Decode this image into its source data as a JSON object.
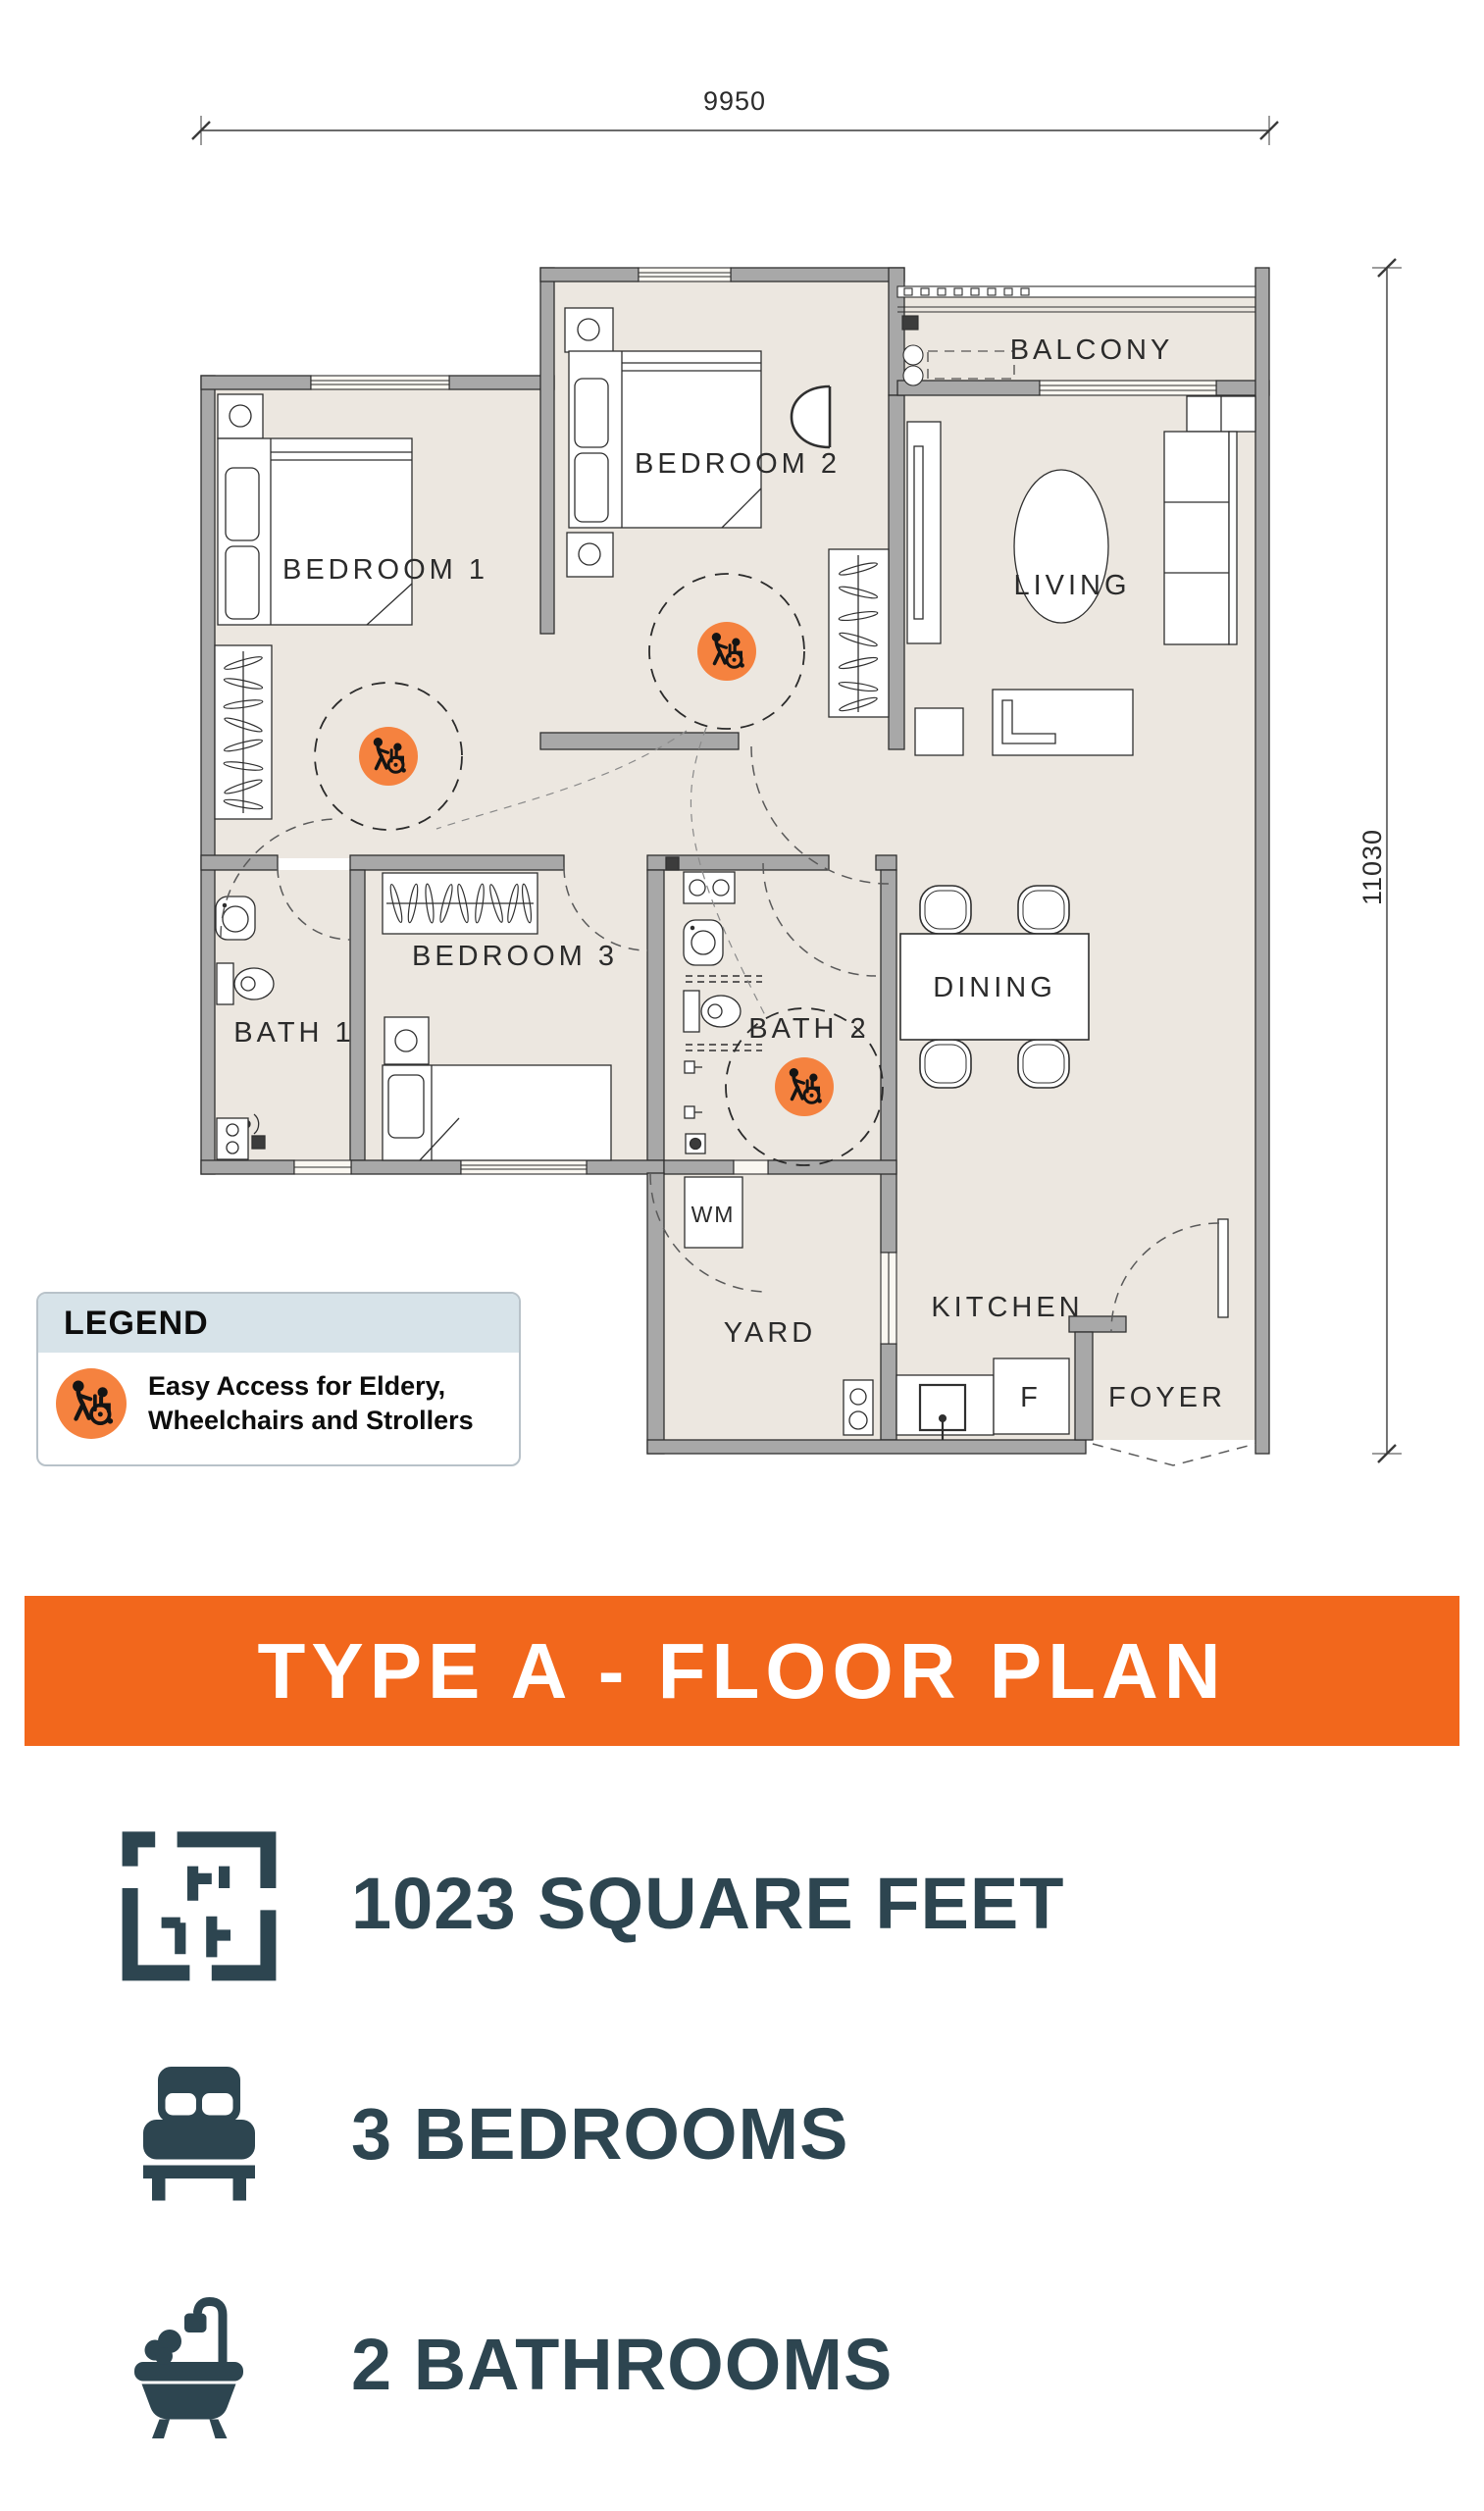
{
  "plan": {
    "dimensions": {
      "width": "9950",
      "height": "11030"
    },
    "labels": {
      "bedroom1": "BEDROOM 1",
      "bedroom2": "BEDROOM 2",
      "bedroom3": "BEDROOM 3",
      "bath1": "BATH 1",
      "bath2": "BATH 2",
      "living": "LIVING",
      "dining": "DINING",
      "kitchen": "KITCHEN",
      "balcony": "BALCONY",
      "yard": "YARD",
      "wm": "WM",
      "fridge": "F",
      "foyer": "FOYER"
    }
  },
  "legend": {
    "title": "LEGEND",
    "item": {
      "icon": "easy-access-icon",
      "line1": "Easy Access for Eldery,",
      "line2": "Wheelchairs and Strollers"
    }
  },
  "banner": {
    "title": "TYPE A - FLOOR PLAN"
  },
  "features": [
    {
      "icon": "floorplan-icon",
      "label": "1023 SQUARE FEET"
    },
    {
      "icon": "bed-icon",
      "label": "3 BEDROOMS"
    },
    {
      "icon": "bathtub-icon",
      "label": "2 BATHROOMS"
    }
  ],
  "colors": {
    "banner_orange": "#f2671c",
    "badge_orange": "#f5823f",
    "dark_slate": "#2d4550",
    "legend_header_blue": "#d7e3e9",
    "floor_beige": "#ece7e0",
    "wall_gray": "#a8a8a8"
  }
}
